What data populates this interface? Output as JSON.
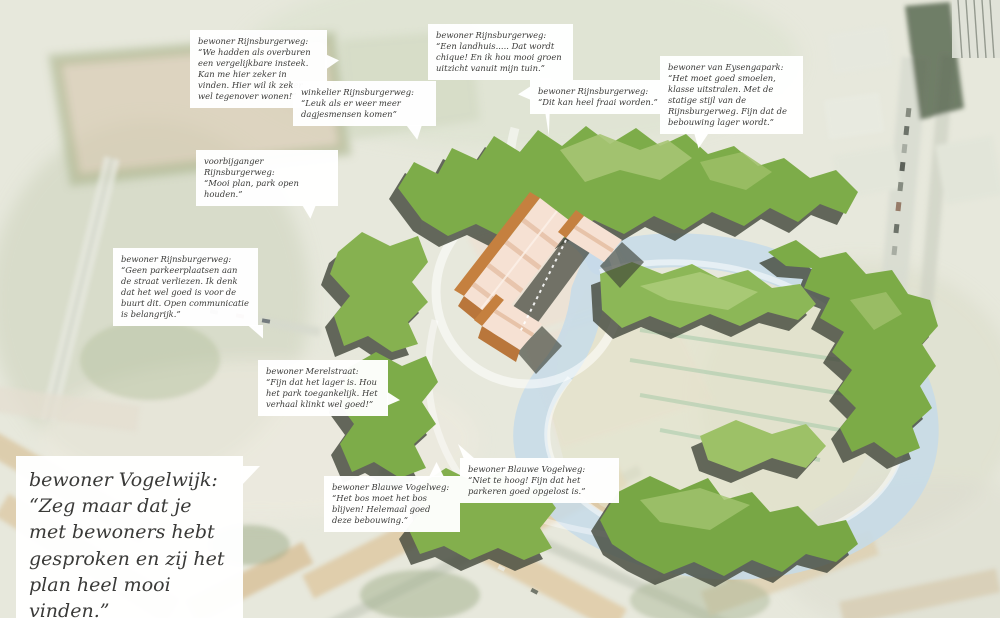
{
  "description": "Aerial masterplan visualization of a park with pond, tree clusters, new low-rise housing blocks and speech-bubble quotes from residents",
  "palette": {
    "background": "#e7e8dc",
    "tree_green": "#7dac49",
    "tree_green_light": "#a6c473",
    "tree_shadow": "#454a3e",
    "water": "#c6dae9",
    "meadow": "#e2e3c9",
    "building_roof": "#f6e1d3",
    "building_side": "#c5803f",
    "path_white": "#ffffff",
    "callout_bg": "#ffffff",
    "callout_text": "#3a3a38"
  },
  "callouts": [
    {
      "speaker": "bewoner Rijnsburgerweg:",
      "quote": "“We hadden als overburen een vergelijkbare insteek. Kan me hier zeker in vinden. Hier wil ik zeker wel tegenover wonen!”"
    },
    {
      "speaker": "winkelier Rijnsburgerweg:",
      "quote": "“Leuk als er weer meer dagjesmensen komen”"
    },
    {
      "speaker": "bewoner Rijnsburgerweg:",
      "quote": "“Een landhuis..... Dat wordt chique! En ik hou mooi groen uitzicht vanuit mijn tuin.”"
    },
    {
      "speaker": "bewoner Rijnsburgerweg:",
      "quote": "“Dit kan heel fraai worden.”"
    },
    {
      "speaker": "bewoner van Eysengapark:",
      "quote": "“Het moet goed smoelen, klasse uitstralen. Met de statige stijl van de Rijnsburgerweg. Fijn dat de bebouwing lager wordt.”"
    },
    {
      "speaker": "voorbijganger Rijnsburgerweg:",
      "quote": "“Mooi plan, park open houden.”"
    },
    {
      "speaker": "bewoner Rijnsburgerweg:",
      "quote": "“Geen parkeerplaatsen aan de straat verliezen. Ik denk dat het wel goed is voor de buurt dit. Open communicatie is belangrijk.”"
    },
    {
      "speaker": "bewoner Merelstraat:",
      "quote": "“Fijn dat het lager is. Hou het park toegankelijk. Het verhaal klinkt wel goed!”"
    },
    {
      "speaker": "bewoner Blauwe Vogelweg:",
      "quote": "“Het bos moet het bos blijven! Helemaal goed deze bebouwing.”"
    },
    {
      "speaker": "bewoner Blauwe Vogelweg:",
      "quote": "“Niet te hoog! Fijn dat het parkeren goed opgelost is.”"
    }
  ],
  "featured_quote": {
    "speaker": "bewoner Vogelwijk:",
    "quote": "“Zeg maar dat je met bewoners hebt gesproken en zij het plan heel mooi vinden.”"
  }
}
